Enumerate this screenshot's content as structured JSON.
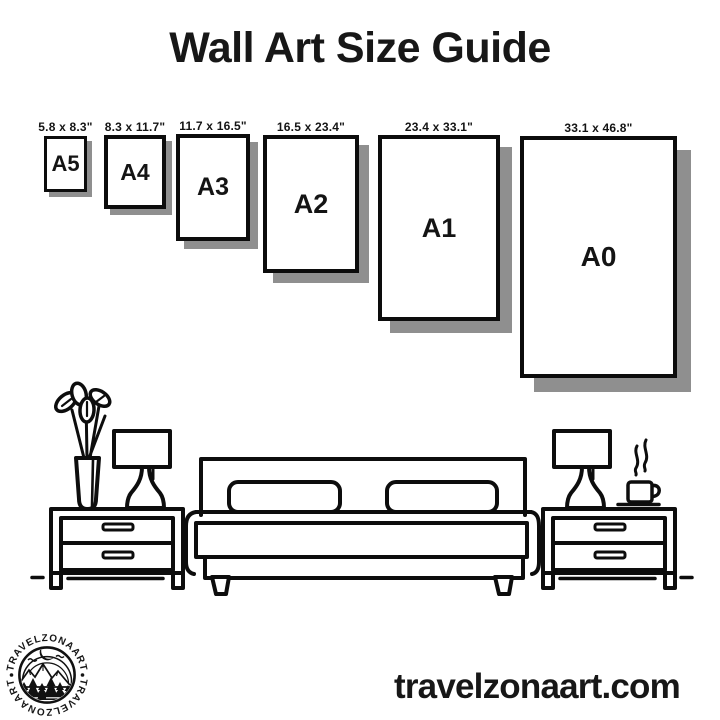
{
  "title": "Wall Art Size Guide",
  "website": "travelzonaart.com",
  "logo": {
    "arc_text": "TRAVELZONAART"
  },
  "colors": {
    "ink": "#141414",
    "line": "#0d0d0d",
    "shadow": "#8f8f8f",
    "background": "#ffffff"
  },
  "frames": [
    {
      "code": "A5",
      "dimensions": "5.8 x 8.3\""
    },
    {
      "code": "A4",
      "dimensions": "8.3 x 11.7\""
    },
    {
      "code": "A3",
      "dimensions": "11.7 x 16.5\""
    },
    {
      "code": "A2",
      "dimensions": "16.5 x 23.4\""
    },
    {
      "code": "A1",
      "dimensions": "23.4 x 33.1\""
    },
    {
      "code": "A0",
      "dimensions": "33.1 x 46.8\""
    }
  ],
  "illustration": {
    "icons": [
      "vase-plant-icon",
      "table-lamp-icon",
      "nightstand-icon",
      "double-bed-icon",
      "coffee-cup-icon",
      "mountain-logo-icon"
    ]
  }
}
